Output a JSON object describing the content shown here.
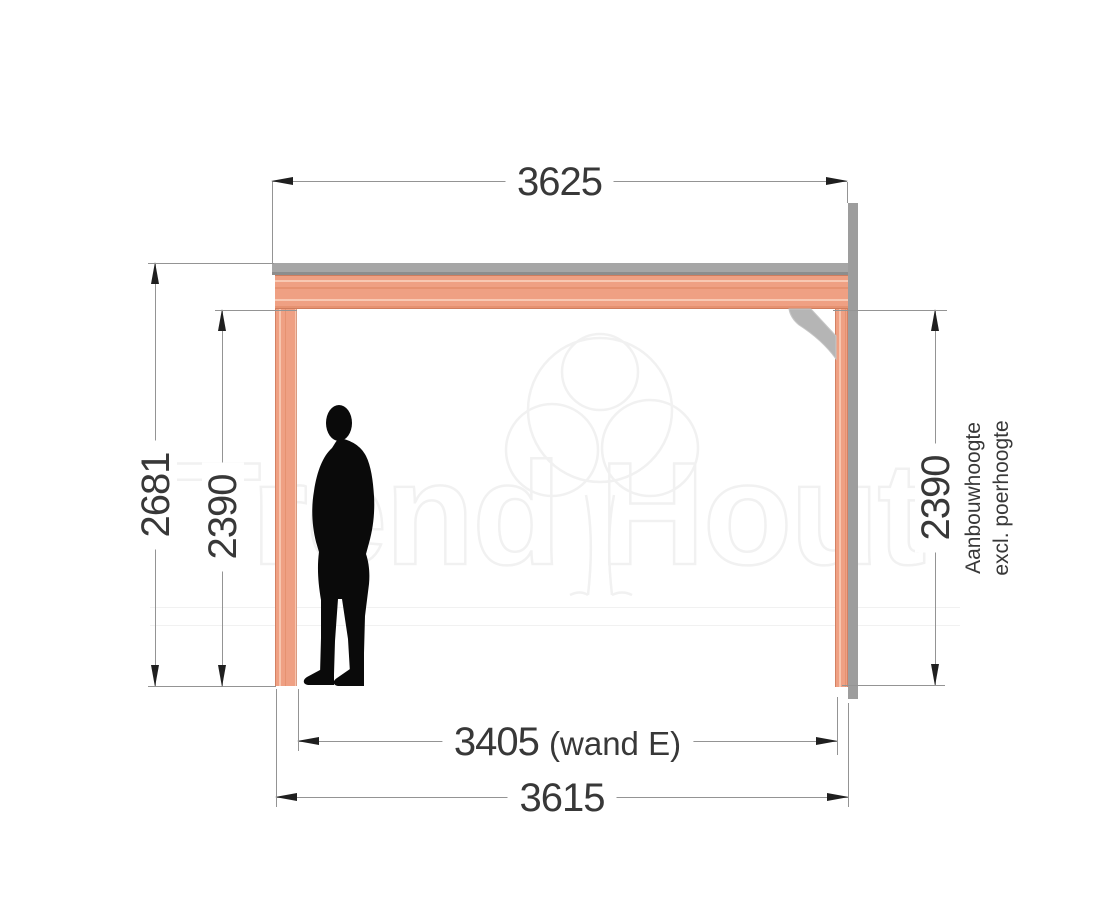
{
  "drawing": {
    "dimensions": {
      "top_width": "3625",
      "outer_height": "2681",
      "inner_height_left": "2390",
      "inner_height_right": "2390",
      "inner_width": "3405",
      "inner_width_note": "(wand E)",
      "bottom_width": "3615"
    },
    "notes": {
      "right_line1": "Aanbouwhoogte",
      "right_line2": "excl. poerhoogte"
    },
    "watermark": {
      "word_left": "Trend",
      "word_right": "Hout"
    }
  },
  "colors": {
    "wood": "#efa083",
    "roof_plate": "#a6a6a6",
    "roof_plate_edge": "#8d8d8d",
    "wall": "#9d9d9d",
    "brace": "#b5b5b5",
    "dim_line": "#949494",
    "dim_arrow": "#1f1f1f",
    "dim_text": "#383838",
    "silhouette": "#0a0a0a",
    "watermark_line": "#f1f1f1"
  }
}
